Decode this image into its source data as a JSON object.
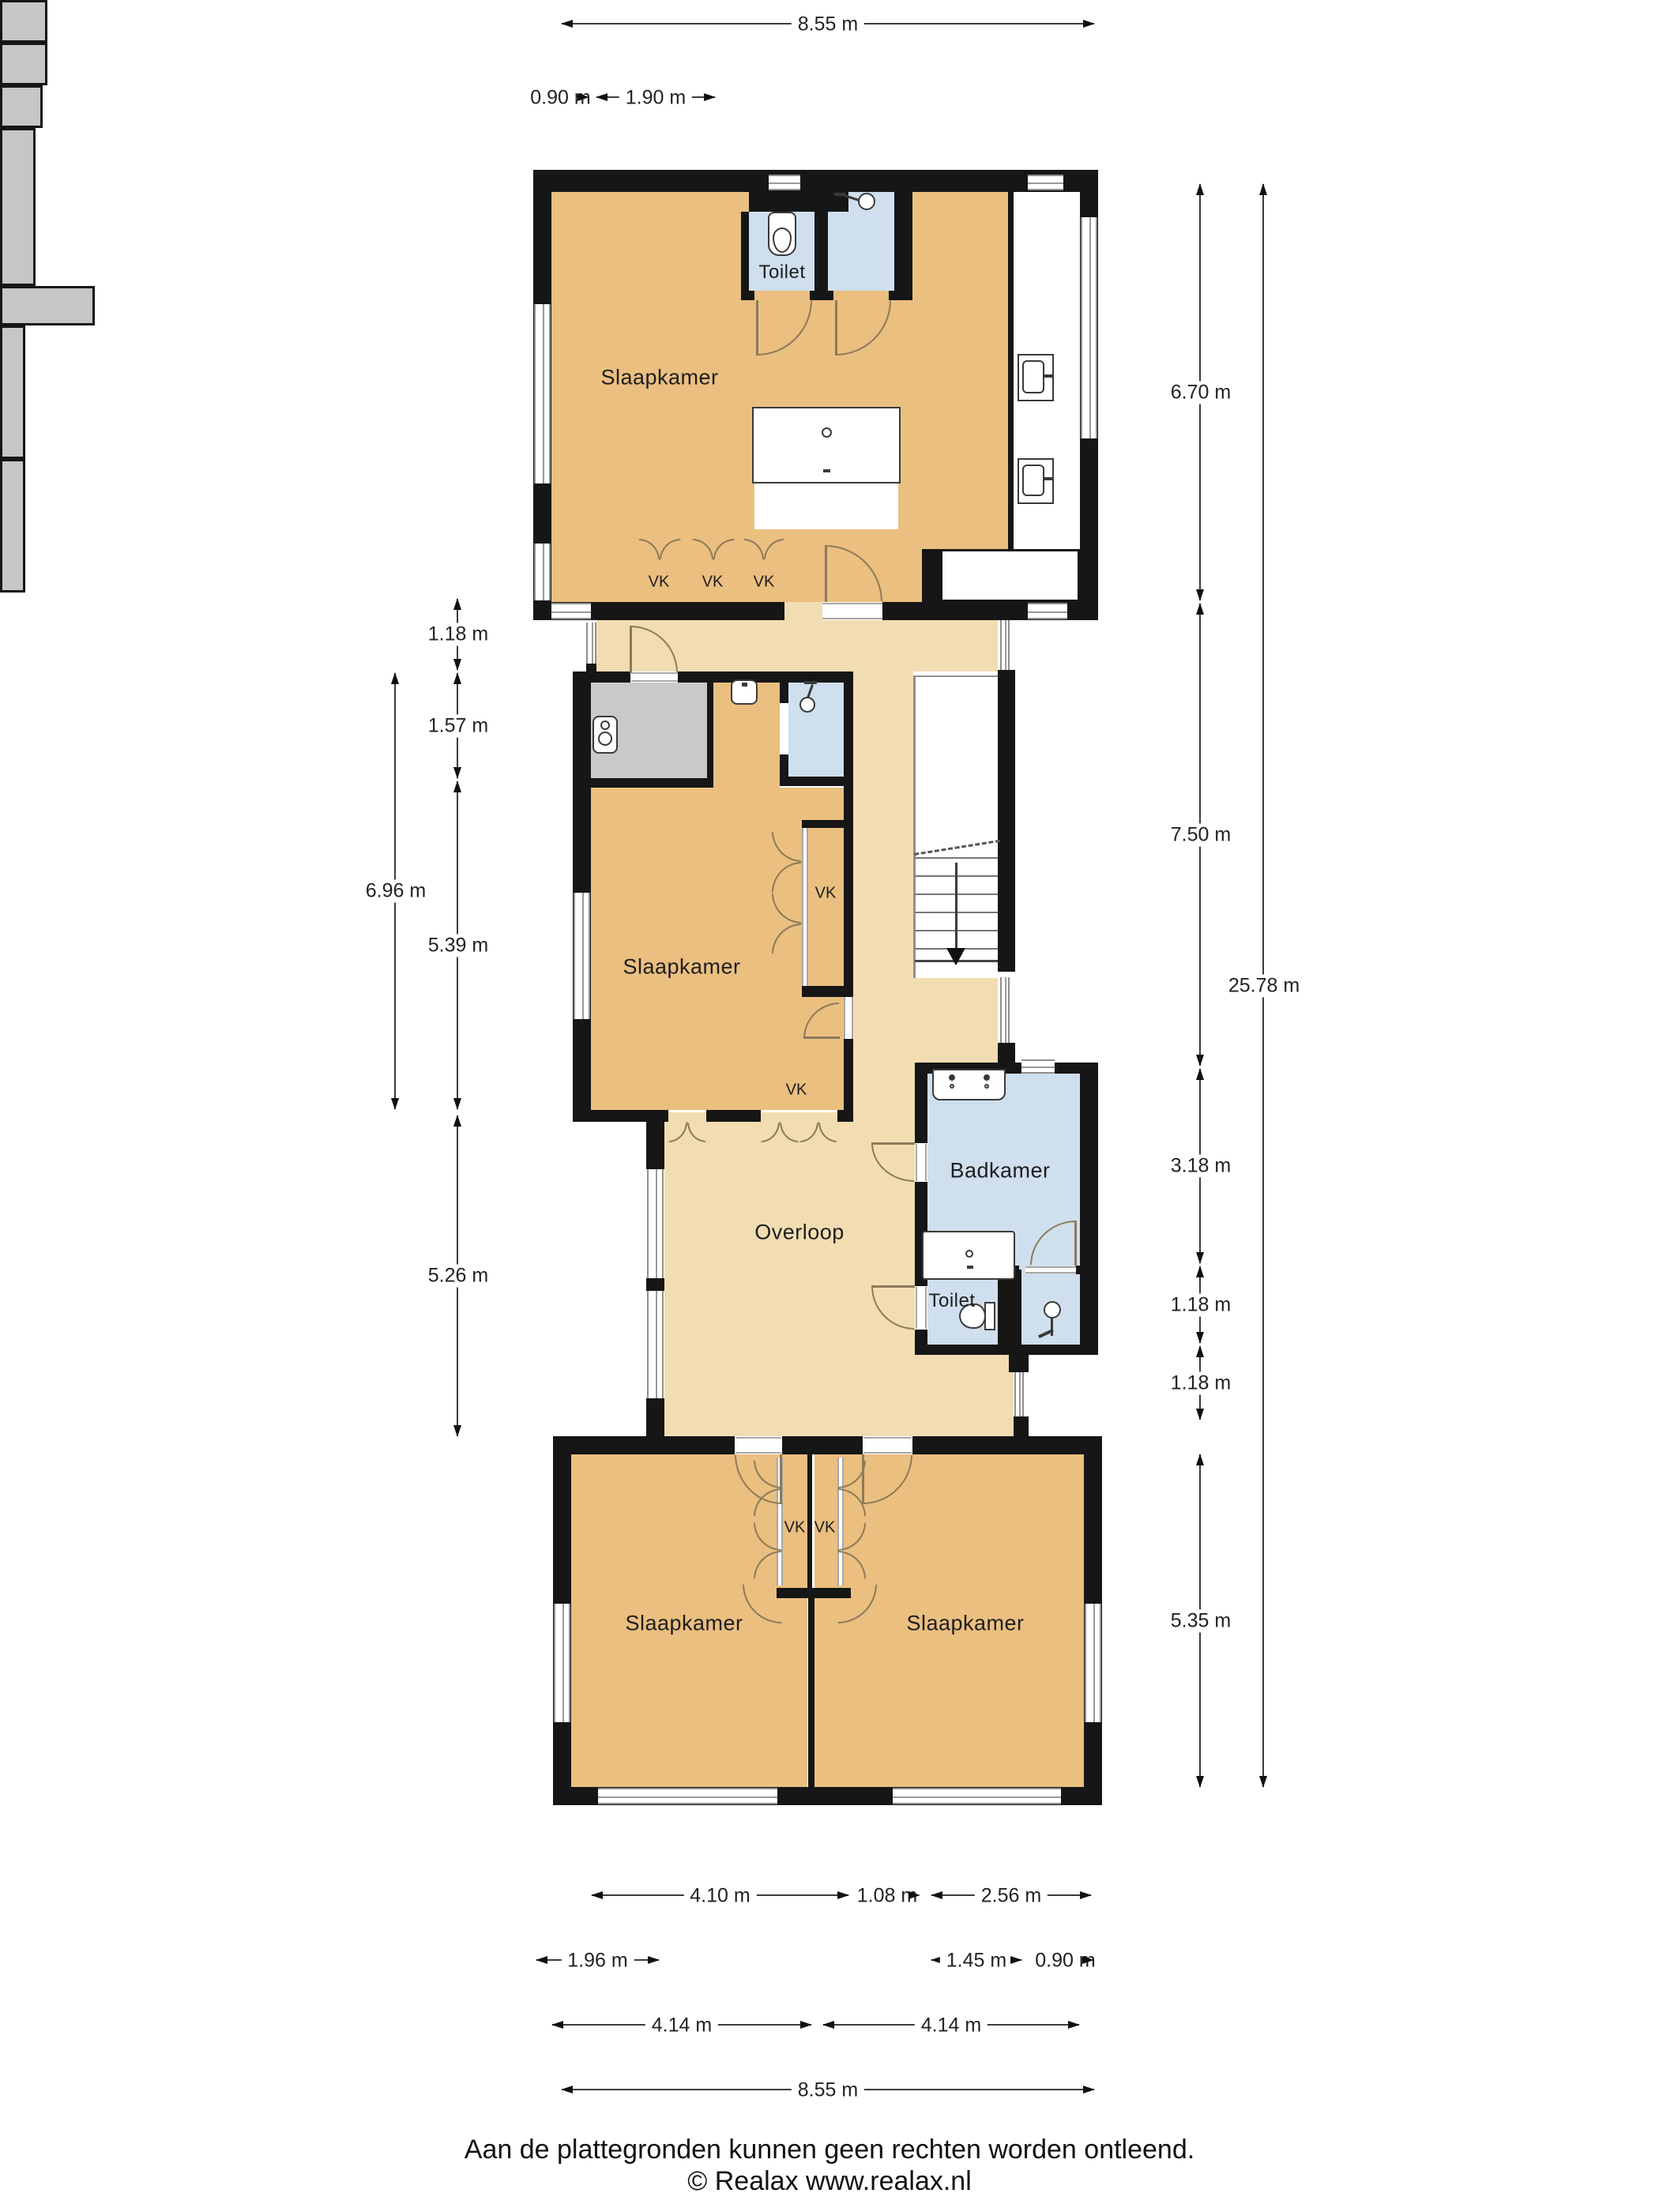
{
  "rooms": {
    "slaapkamer": "Slaapkamer",
    "toilet": "Toilet",
    "badkamer": "Badkamer",
    "overloop": "Overloop",
    "vk": "VK"
  },
  "dims": {
    "top": [
      "8.55 m",
      "0.90 m",
      "1.90 m"
    ],
    "left": [
      "1.18 m",
      "1.57 m",
      "5.39 m",
      "5.26 m",
      "6.96 m"
    ],
    "right": [
      "6.70 m",
      "7.50 m",
      "3.18 m",
      "1.18 m",
      "1.18 m",
      "5.35 m",
      "25.78 m"
    ],
    "bottom": [
      "4.10 m",
      "1.08 m",
      "2.56 m",
      "1.96 m",
      "1.45 m",
      "0.90 m",
      "4.14 m",
      "4.14 m",
      "8.55 m"
    ]
  },
  "footer": {
    "line1": "Aan de plattegronden kunnen geen rechten worden ontleend.",
    "line2": "© Realax www.realax.nl"
  },
  "colors": {
    "wall": "#161616",
    "bedroom_fill": "#eabf80",
    "hallway_fill": "#f2ddb2",
    "wet_room_fill": "#cfdfee",
    "tech_room_fill": "#c9c9c9",
    "closet_fill": "#c6c6c6",
    "door_arc": "#8d7a58"
  }
}
